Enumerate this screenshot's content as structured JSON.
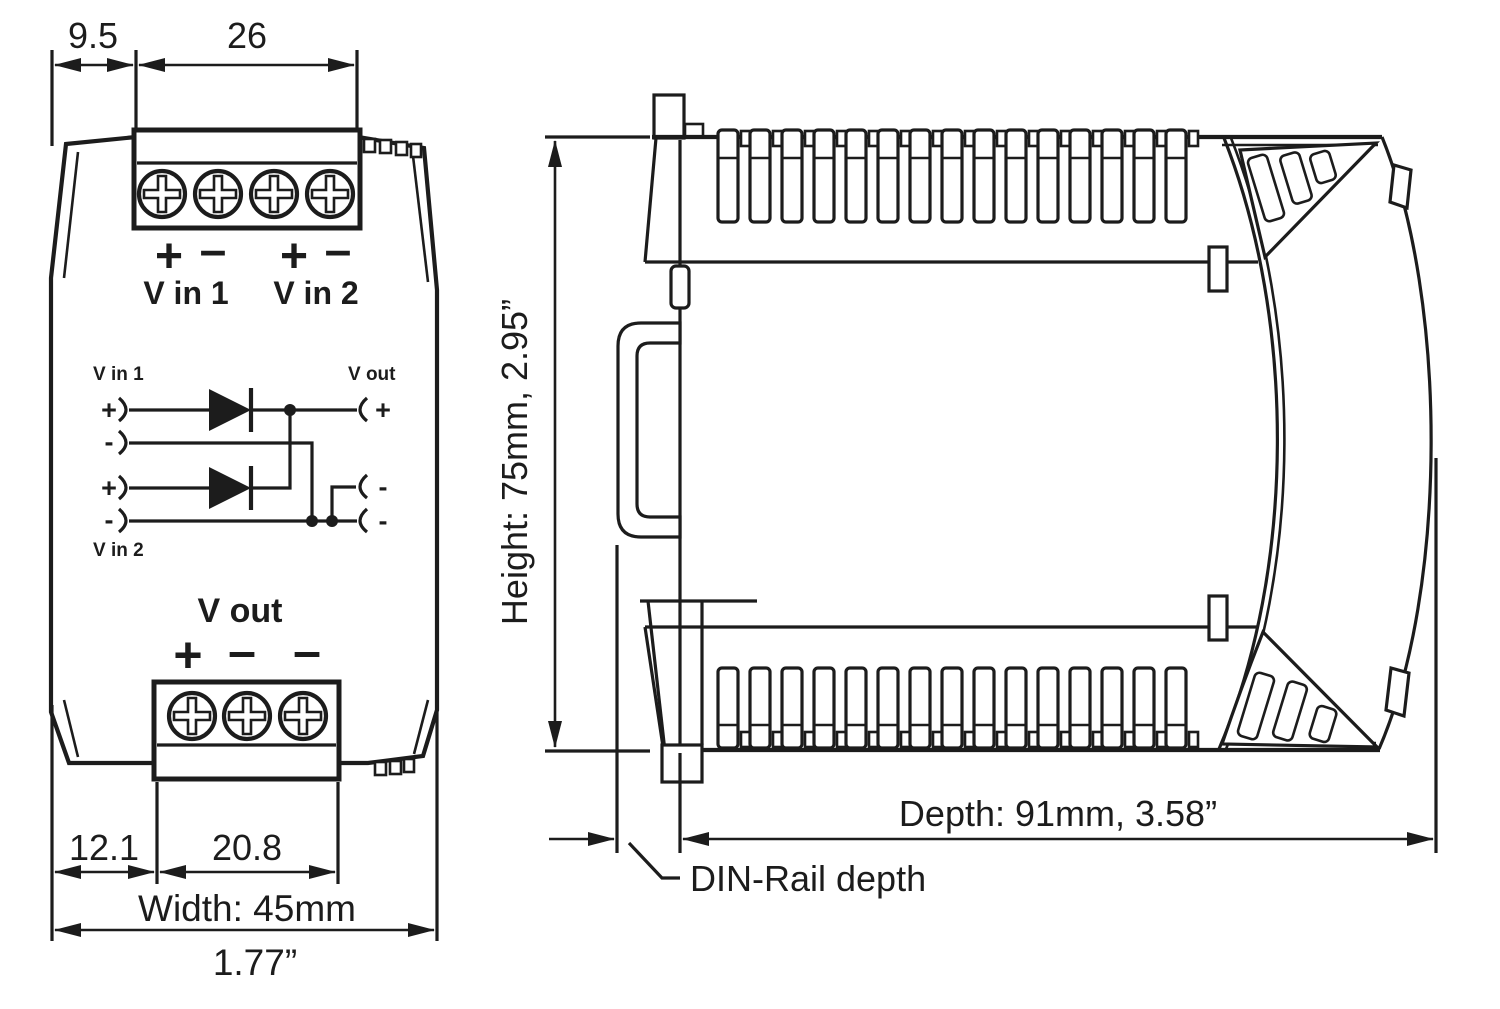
{
  "front_view": {
    "dims": {
      "offset_top": "9.5",
      "terminal_top_width": "26",
      "offset_bottom": "12.1",
      "terminal_bottom_width": "20.8",
      "width_mm": "Width: 45mm",
      "width_inch": "1.77”"
    },
    "labels": {
      "v_in_1": "V in 1",
      "v_in_2": "V in 2",
      "v_out": "V out",
      "plus": "+",
      "minus": "–"
    }
  },
  "circuit": {
    "v_in_1": "V in 1",
    "v_in_2": "V in 2",
    "v_out": "V out",
    "plus": "+",
    "minus": "-"
  },
  "side_view": {
    "height": "Height: 75mm,  2.95”",
    "depth": "Depth: 91mm,  3.58”",
    "din_rail": "DIN-Rail depth"
  }
}
